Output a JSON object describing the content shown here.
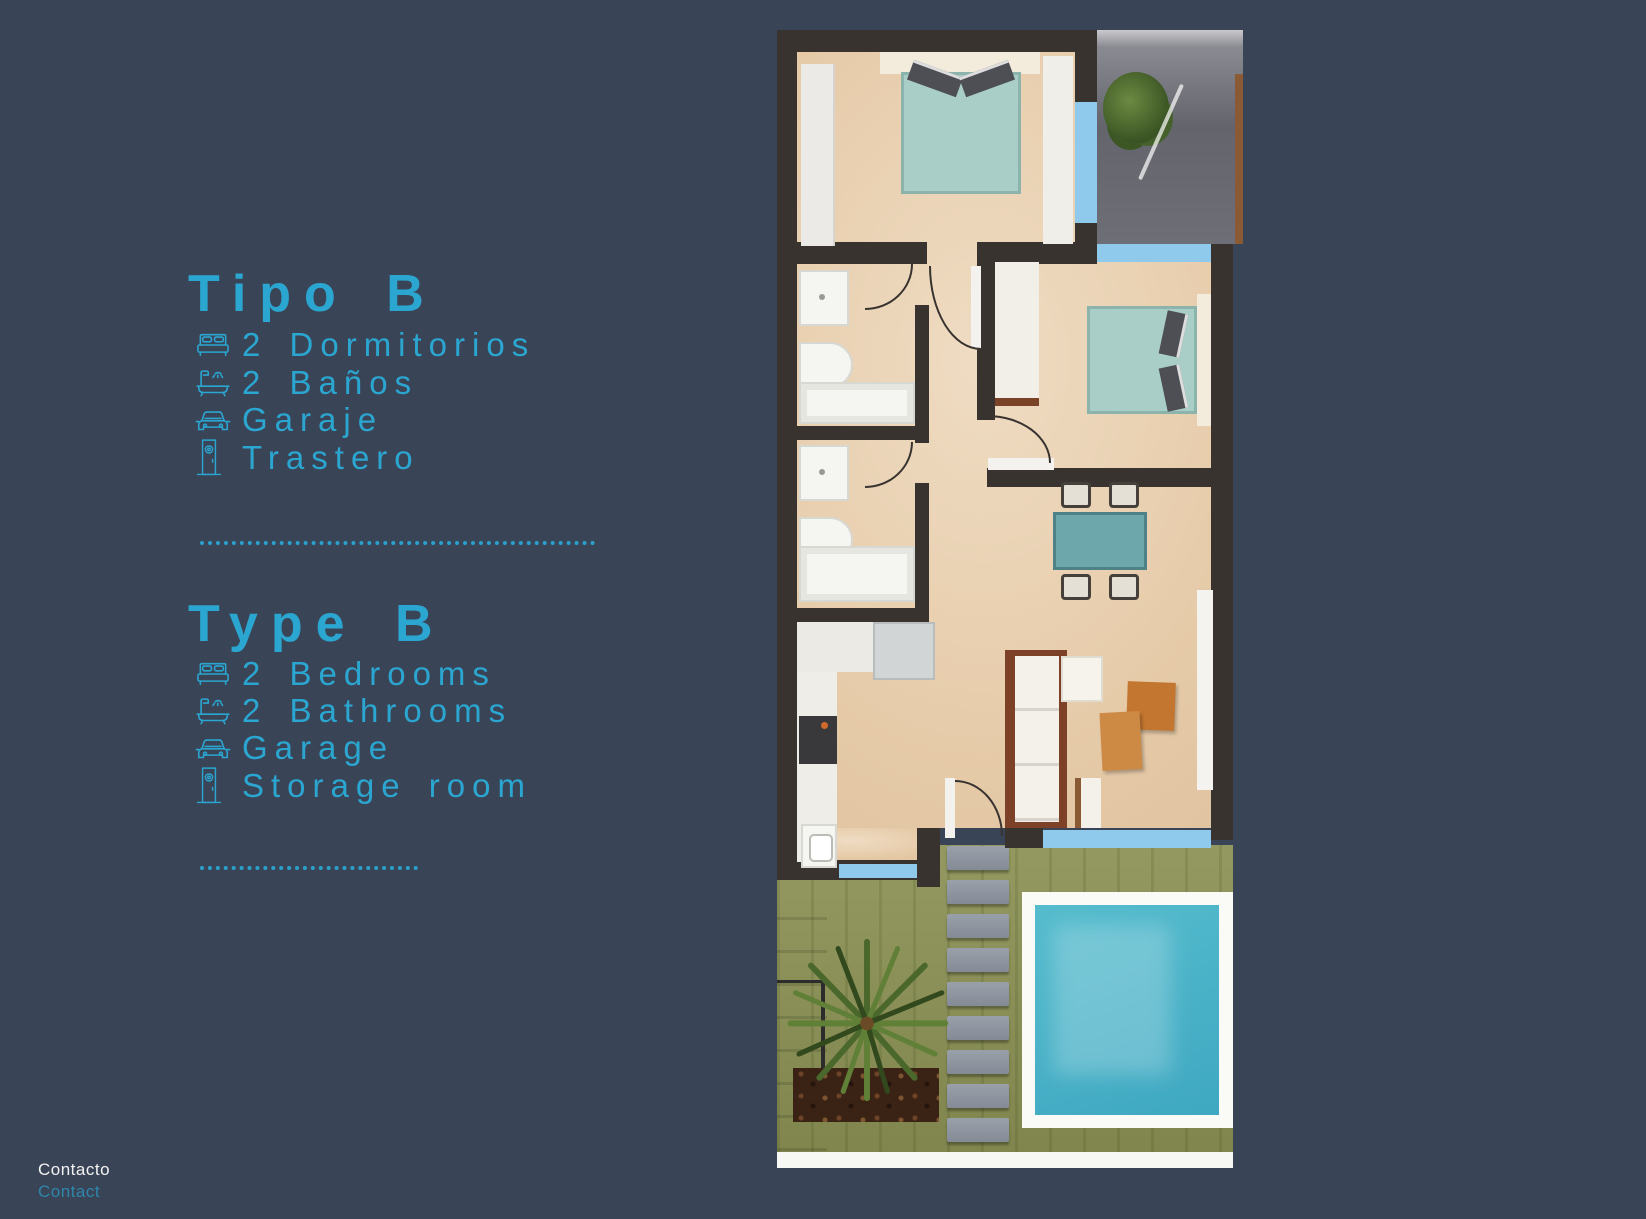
{
  "page": {
    "background_color": "#3a4457",
    "accent_color": "#2aa6d0"
  },
  "sections": [
    {
      "heading": "Tipo B",
      "items": [
        {
          "icon": "bed-icon",
          "label": "2 Dormitorios"
        },
        {
          "icon": "bathtub-icon",
          "label": "2 Baños"
        },
        {
          "icon": "car-icon",
          "label": "Garaje"
        },
        {
          "icon": "door-icon",
          "label": "Trastero"
        }
      ]
    },
    {
      "heading": "Type B",
      "items": [
        {
          "icon": "bed-icon",
          "label": "2 Bedrooms"
        },
        {
          "icon": "bathtub-icon",
          "label": "2 Bathrooms"
        },
        {
          "icon": "car-icon",
          "label": "Garage"
        },
        {
          "icon": "door-icon",
          "label": "Storage room"
        }
      ]
    }
  ],
  "footer": {
    "contact_label_es": "Contacto",
    "contact_label_en": "Contact",
    "contact_en_color": "#2e86aa"
  },
  "floor_plan": {
    "colors": {
      "wall": "#38332f",
      "floor": "#e7ccae",
      "window": "#8fc9ec",
      "bed_linen": "#a8cec7",
      "pool_water": "#45b0c5",
      "pool_deck": "#fafaf7",
      "grass": "#8b9154",
      "terrace": "#66666e",
      "wood": "#7a4226"
    },
    "elements": [
      "bedroom-1",
      "bedroom-2",
      "bathroom-1",
      "bathroom-2",
      "kitchen",
      "living-room",
      "dining-area",
      "terrace",
      "garden",
      "swimming-pool",
      "stepping-stones",
      "palm-tree",
      "entrance-stairs"
    ]
  }
}
